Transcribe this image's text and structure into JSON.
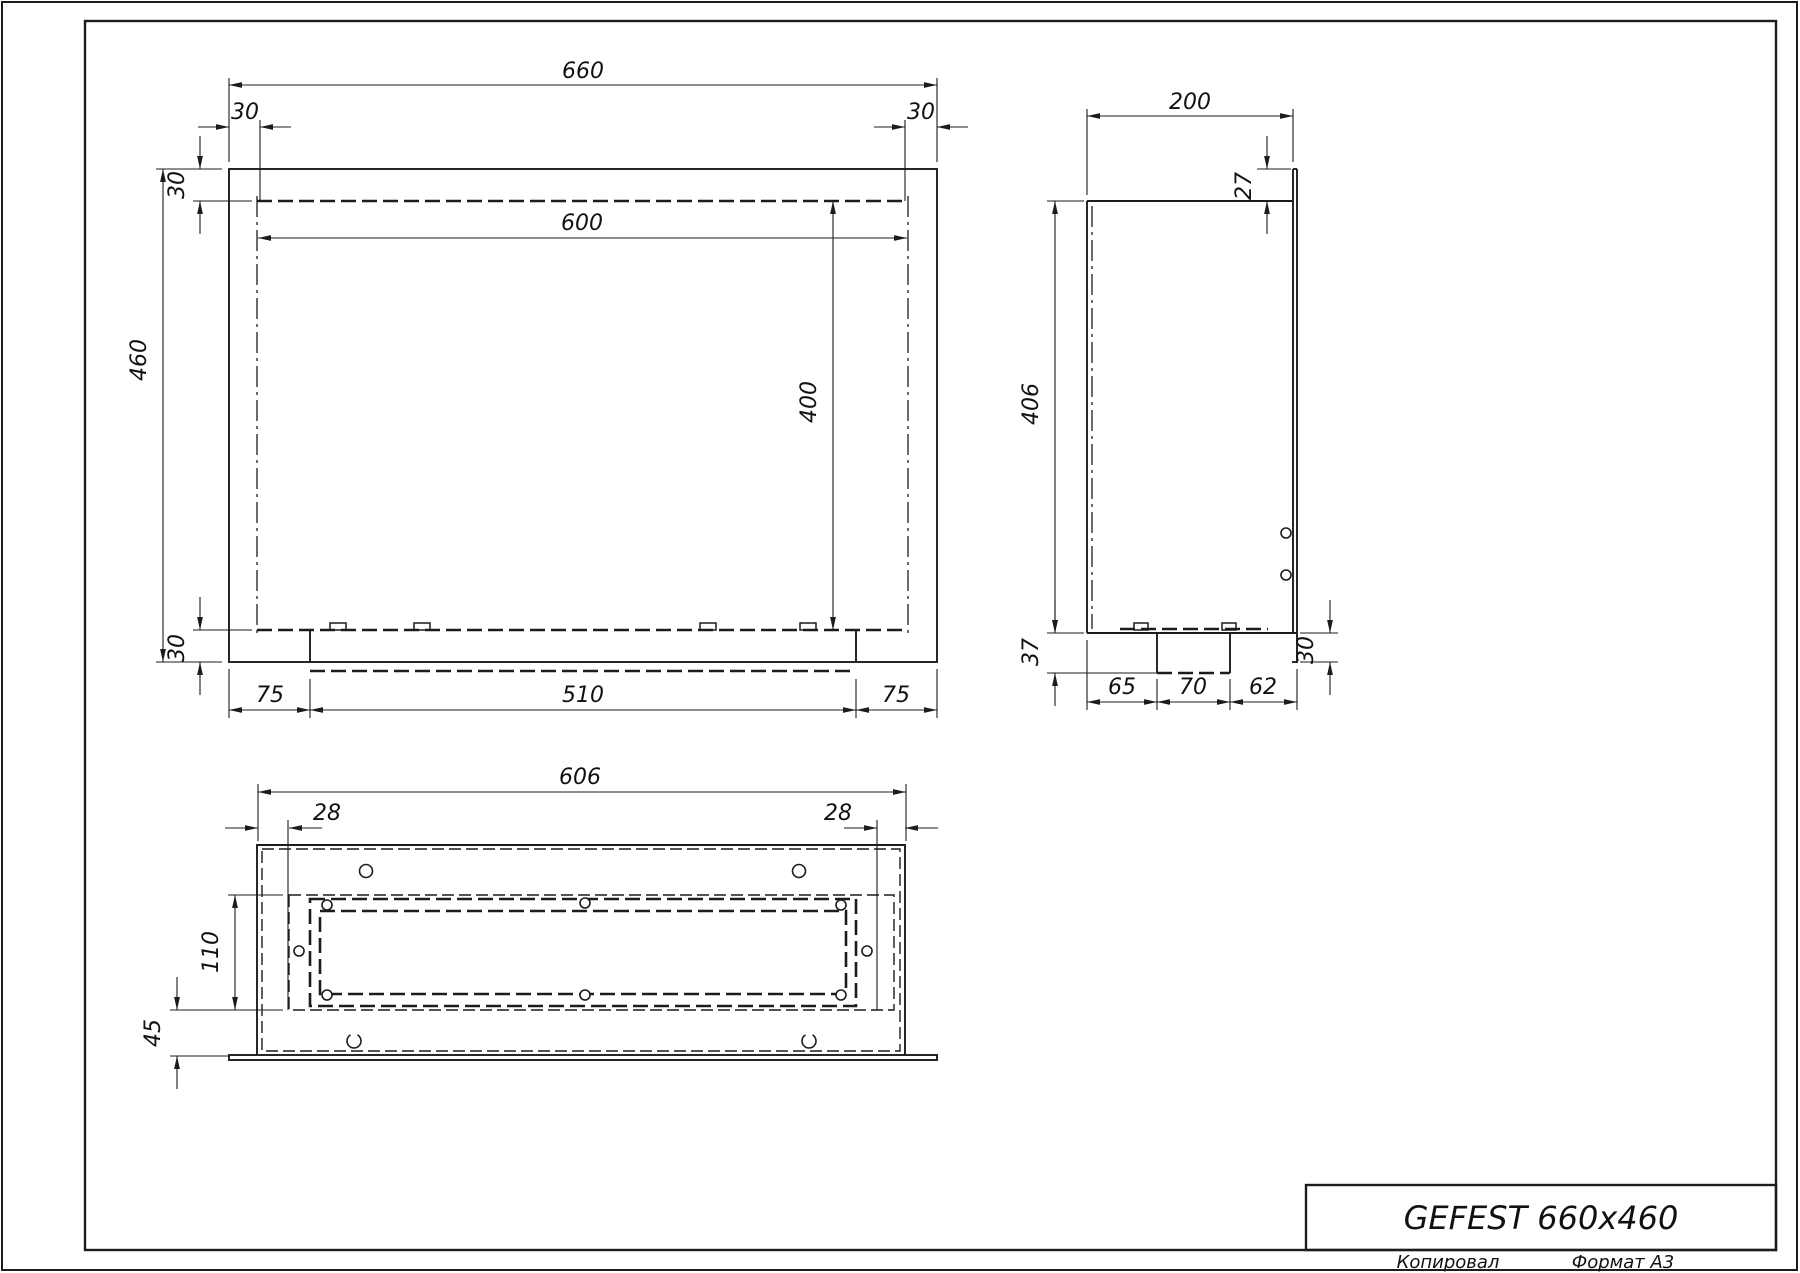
{
  "title_block": {
    "title": "GEFEST 660x460",
    "copied_label": "Копировал",
    "format_label": "Формат А3"
  },
  "front_view": {
    "dim_width_total": "660",
    "dim_flange_left": "30",
    "dim_flange_right": "30",
    "dim_opening_width": "600",
    "dim_height_total": "460",
    "dim_top_band": "30",
    "dim_opening_height": "400",
    "dim_bottom_band": "30",
    "dim_bottom_left": "75",
    "dim_bottom_center": "510",
    "dim_bottom_right": "75"
  },
  "side_view": {
    "dim_depth": "200",
    "dim_lip": "27",
    "dim_height": "406",
    "dim_bottom_plate": "37",
    "dim_seg_left": "65",
    "dim_seg_center": "70",
    "dim_seg_right": "62",
    "dim_flange_drop": "30"
  },
  "bottom_view": {
    "dim_width": "606",
    "dim_inset_left": "28",
    "dim_inset_right": "28",
    "dim_frame_height": "110",
    "dim_front_offset": "45"
  }
}
